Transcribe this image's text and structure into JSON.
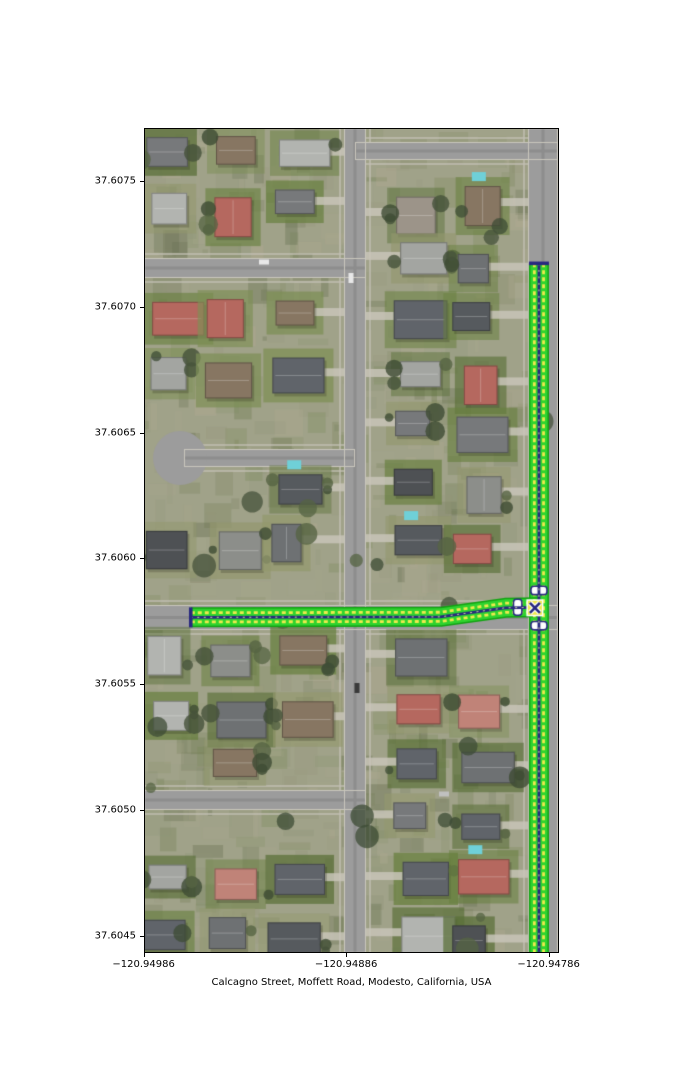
{
  "figure": {
    "xlabel": "Calcagno Street, Moffett Road, Modesto, California, USA",
    "x_tick_labels": [
      "−120.94986",
      "−120.94886",
      "−120.94786"
    ],
    "y_tick_labels": [
      "37.6075",
      "37.6070",
      "37.6065",
      "37.6060",
      "37.6055",
      "37.6050",
      "37.6045"
    ]
  },
  "chart_data": {
    "type": "map",
    "title": "",
    "xlabel": "Calcagno Street, Moffett Road, Modesto, California, USA",
    "x_ticks": [
      -120.94986,
      -120.94886,
      -120.94786
    ],
    "y_ticks": [
      37.6075,
      37.607,
      37.6065,
      37.606,
      37.6055,
      37.605,
      37.6045
    ],
    "xlim": [
      -120.949858,
      -120.947809
    ],
    "ylim": [
      37.604432,
      37.607711
    ],
    "grid": false,
    "legend": false,
    "basemap": "aerial imagery of a residential neighborhood, Modesto, California",
    "streets": [
      {
        "name": "Moffett Road",
        "orientation": "north-south",
        "path": [
          [
            -120.947908,
            37.607173
          ],
          [
            -120.947908,
            37.604432
          ]
        ]
      },
      {
        "name": "Calcagno Street",
        "orientation": "east-west",
        "path": [
          [
            -120.949627,
            37.605766
          ],
          [
            -120.948395,
            37.605768
          ],
          [
            -120.948075,
            37.605804
          ],
          [
            -120.947908,
            37.605806
          ]
        ]
      }
    ],
    "street_style": {
      "edge_green": "#12a312",
      "lane_green": "#2fd32f",
      "dash_yellow": "#efe94e",
      "centerline_navy": "#28287f",
      "marker_white": "#ffffff"
    },
    "markers": [
      {
        "type": "end_cap",
        "at": [
          -120.949627,
          37.605766
        ],
        "orientation": "vertical"
      },
      {
        "type": "end_cap",
        "at": [
          -120.947908,
          37.607173
        ],
        "orientation": "horizontal"
      },
      {
        "type": "stop_bar",
        "at": [
          -120.947908,
          37.605873
        ],
        "orientation": "horizontal"
      },
      {
        "type": "stop_bar",
        "at": [
          -120.947908,
          37.605733
        ],
        "orientation": "horizontal"
      },
      {
        "type": "stop_bar",
        "at": [
          -120.948013,
          37.605806
        ],
        "orientation": "vertical"
      },
      {
        "type": "junction_x",
        "at": [
          -120.947928,
          37.605804
        ]
      }
    ]
  }
}
